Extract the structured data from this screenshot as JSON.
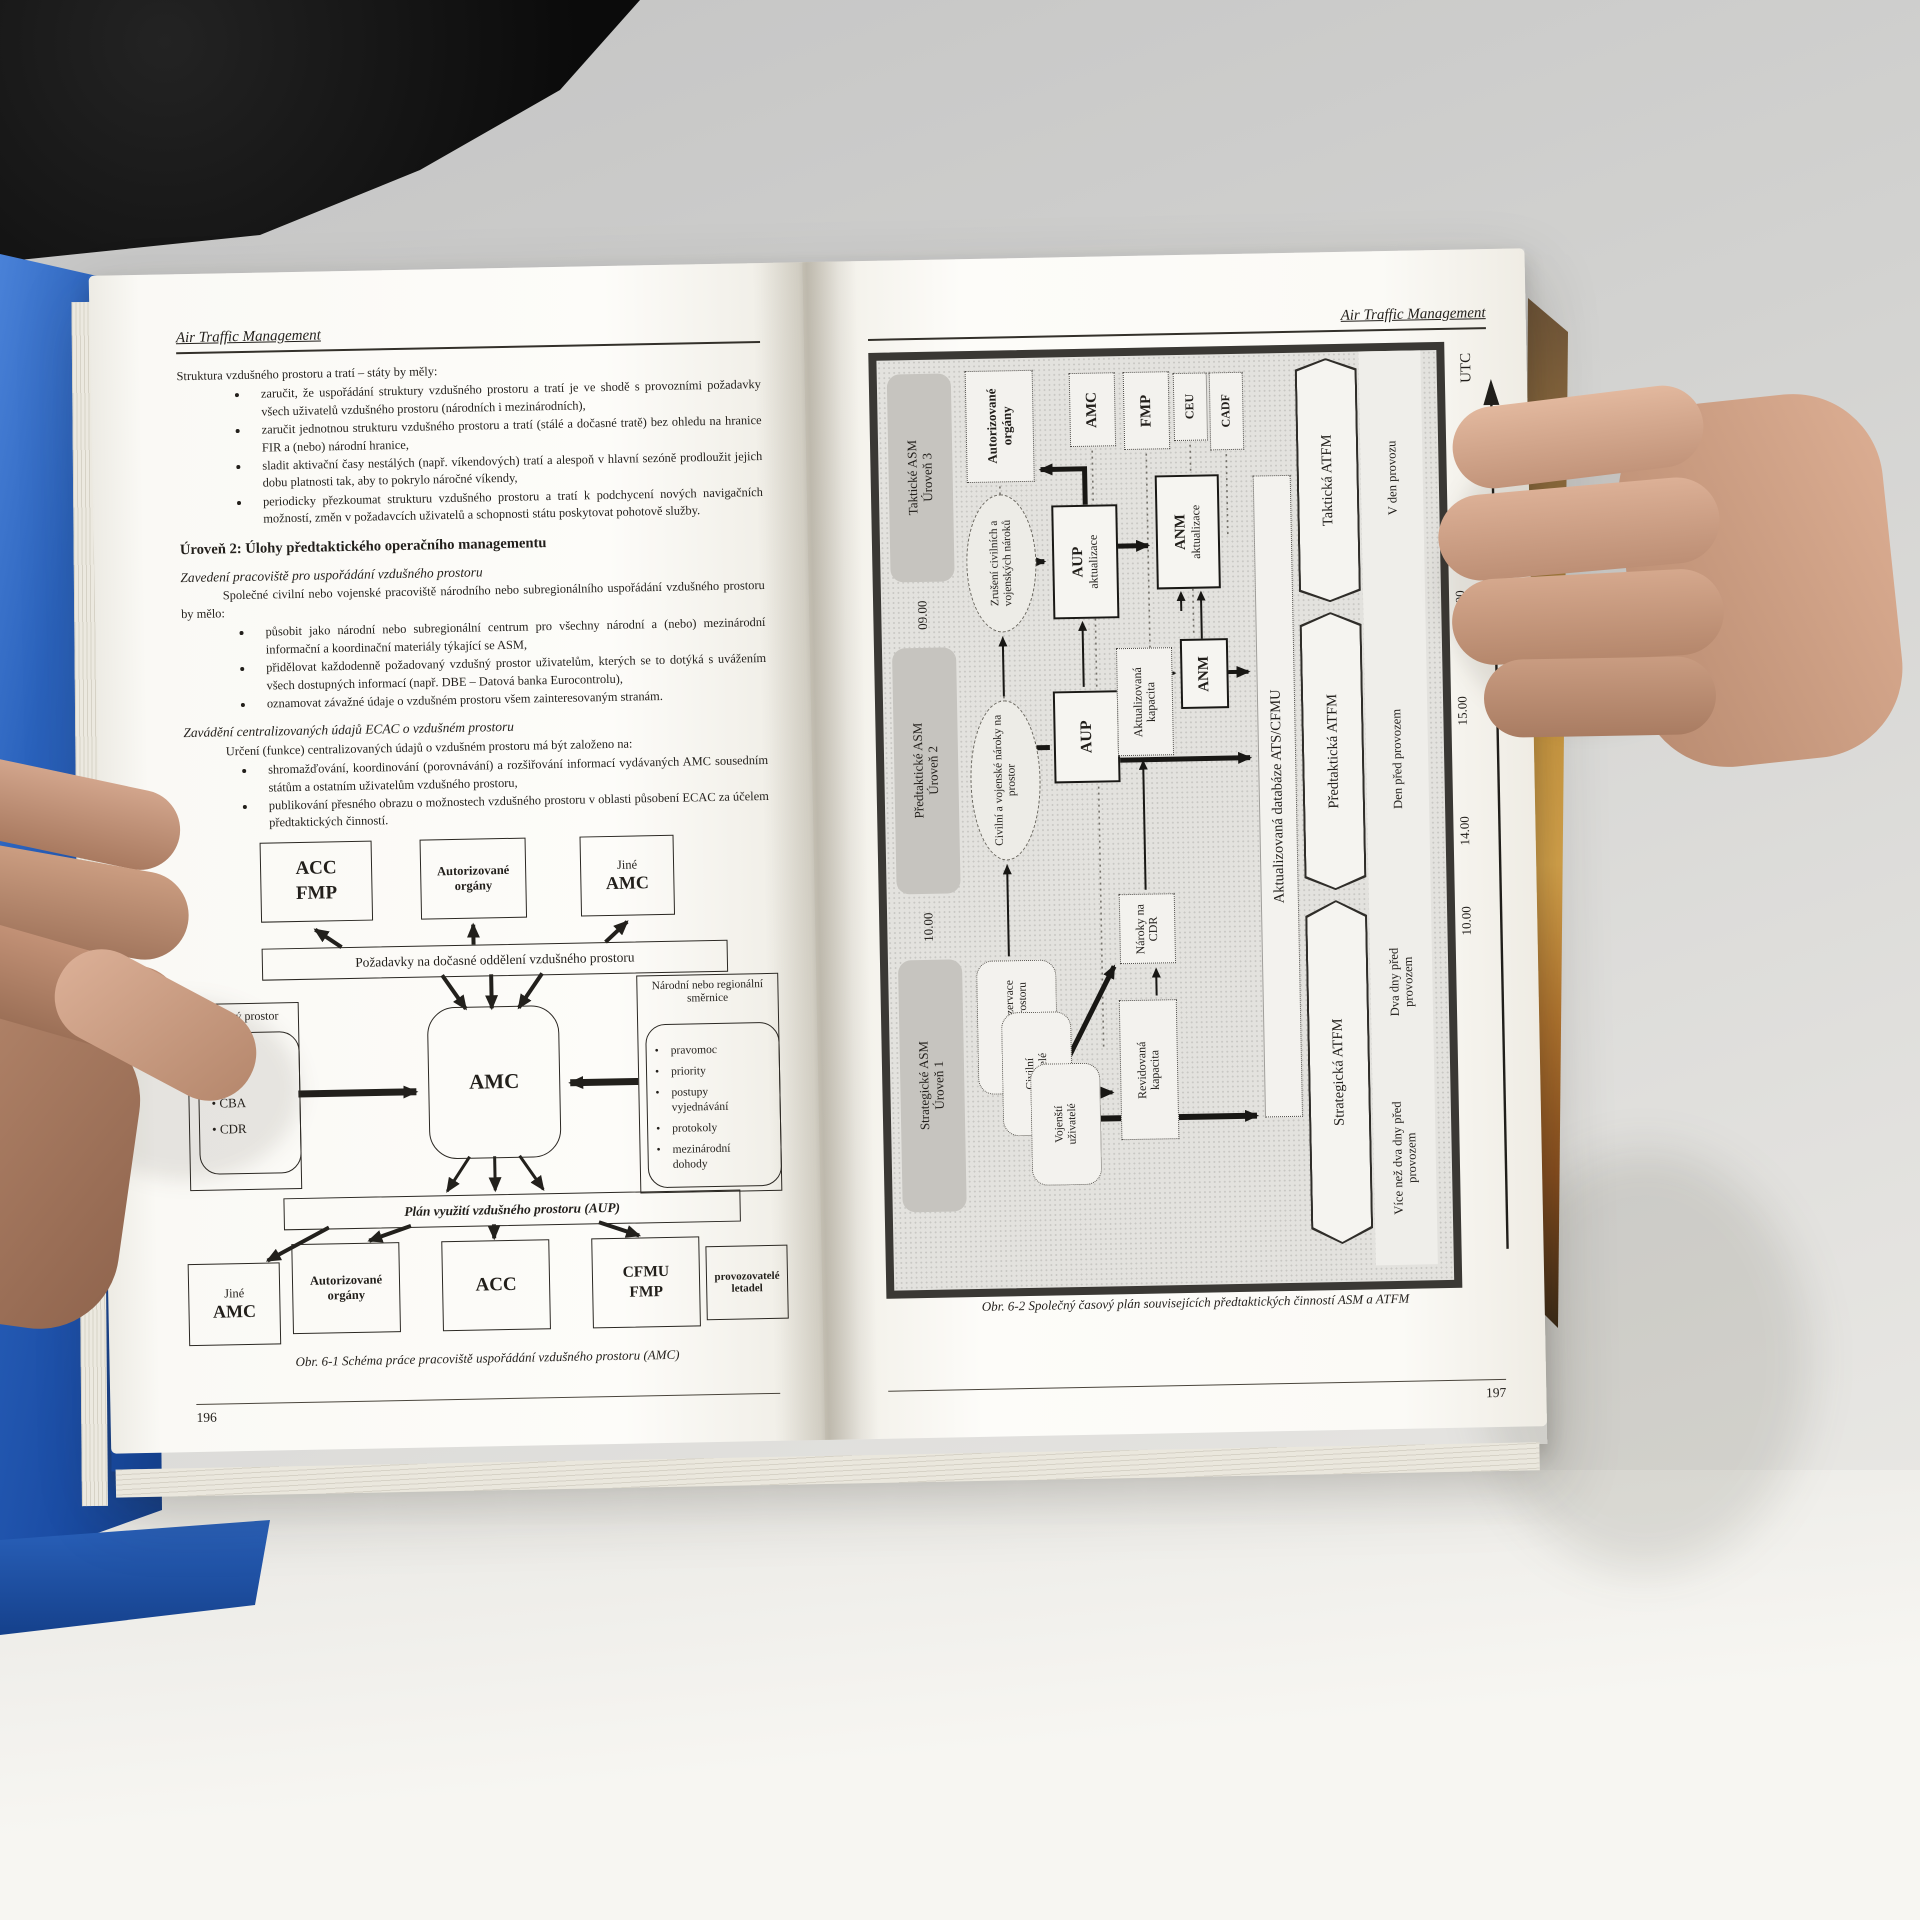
{
  "book": {
    "left_page": {
      "header": "Air Traffic Management",
      "page_number": "196",
      "intro": "Struktura vzdušného prostoru a tratí – státy by měly:",
      "bullets1": [
        "zaručit, že uspořádání struktury vzdušného prostoru a tratí je ve shodě s provozními požadavky všech uživatelů vzdušného prostoru (národních i mezinárodních),",
        "zaručit jednotnou strukturu vzdušného prostoru a tratí (stálé a dočasné tratě) bez ohledu na hranice FIR a (nebo) národní hranice,",
        "sladit aktivační časy nestálých (např. víkendových) tratí a alespoň v hlavní sezóně prodloužit jejich dobu platnosti tak, aby to pokrylo náročné víkendy,",
        "periodicky přezkoumat strukturu vzdušného prostoru a tratí k podchycení nových navigačních možností, změn v požadavcích uživatelů a schopnosti státu poskytovat pohotově služby."
      ],
      "level2_heading": "Úroveň 2: Úlohy předtaktického operačního managementu",
      "section1": {
        "title": "Zavedení pracoviště pro uspořádání vzdušného prostoru",
        "intro": "Společné civilní nebo vojenské pracoviště národního nebo subregionálního uspořádání vzdušného prostoru by mělo:",
        "bullets": [
          "působit jako národní nebo subregionální centrum pro všechny národní a (nebo) mezinárodní informační a koordinační materiály týkající se ASM,",
          "přidělovat každodenně požadovaný vzdušný prostor uživatelům, kterých se to dotýká s uvážením všech dostupných informací (např. DBE – Datová banka Eurocontrolu),",
          "oznamovat závažné údaje o vzdušném prostoru všem zainteresovaným stranám."
        ]
      },
      "section2": {
        "title": "Zavádění centralizovaných údajů ECAC o vzdušném prostoru",
        "intro": "Určení (funkce) centralizovaných údajů o vzdušném prostoru má být založeno na:",
        "bullets": [
          "shromažďování, koordinování (porovnávání) a rozšiřování informací vydávaných AMC sousedním státům a ostatním uživatelům vzdušného prostoru,",
          "publikování přesného obrazu o možnostech vzdušného prostoru v oblasti působení ECAC za účelem předtaktických činností."
        ]
      },
      "figure1": {
        "caption": "Obr. 6-1 Schéma práce pracoviště uspořádání vzdušného prostoru (AMC)",
        "acc_fmp": "ACC FMP",
        "authorized": "Autorizované orgány",
        "jine": "Jiné",
        "amc_label": "AMC",
        "request_bar": "Požadavky na dočasné oddělení vzdušného prostoru",
        "flexible_label": "Pružný prostor",
        "flexible_items": [
          "TSA",
          "CBA",
          "CDR"
        ],
        "amc": "AMC",
        "directives_label": "Národní nebo regionální směrnice",
        "directives_items": [
          "pravomoc",
          "priority",
          "postupy vyjednávání",
          "protokoly",
          "mezinárodní dohody"
        ],
        "aup_bar": "Plán využití vzdušného prostoru (AUP)",
        "acc": "ACC",
        "cfmu_fmp": "CFMU FMP",
        "operators": "provozovatelé letadel"
      }
    },
    "right_page": {
      "header": "Air Traffic Management",
      "page_number": "197",
      "figure2": {
        "caption": "Obr. 6-2 Společný časový plán souvisejících předtaktických činností ASM a ATFM",
        "levels": [
          {
            "name": "Taktické ASM",
            "level": "Úroveň 3"
          },
          {
            "name": "Předtaktické ASM",
            "level": "Úroveň 2"
          },
          {
            "name": "Strategické ASM",
            "level": "Úroveň 1"
          }
        ],
        "authorized": "Autorizované orgány",
        "amc": "AMC",
        "fmp": "FMP",
        "ceu": "CEU",
        "cadf": "CADF",
        "cancel_ellipse": "Zrušení civilních a vojenských nároků",
        "aup_update_title": "AUP",
        "aup_update_sub": "aktualizace",
        "anm_update_title": "ANM",
        "anm_update_sub": "aktualizace",
        "anm": "ANM",
        "updated_capacity": "Aktualizovaná kapacita",
        "aup": "AUP",
        "claims_ellipse": "Civilní a vojenské nároky na prostor",
        "cdr_claims": "Nároky na CDR",
        "database": "Aktualizovaná databáze ATS/CFMU",
        "planned_reservations": "Plánované rezervace vzdušného prostoru",
        "civil_users": "Civilní uživatelé",
        "military_users": "Vojenští uživatelé",
        "revised_capacity": "Revidovaná kapacita",
        "banners": [
          "Taktická ATFM",
          "Předtaktická ATFM",
          "Strategická ATFM"
        ],
        "periods": [
          "V den provozu",
          "Den před provozem",
          "Dva dny před provozem",
          "Více než dva dny před provozem"
        ],
        "times": {
          "utc": "UTC",
          "t1": "09.00",
          "t2": "15.00",
          "t3": "14.00",
          "t4": "10.00"
        }
      }
    }
  }
}
